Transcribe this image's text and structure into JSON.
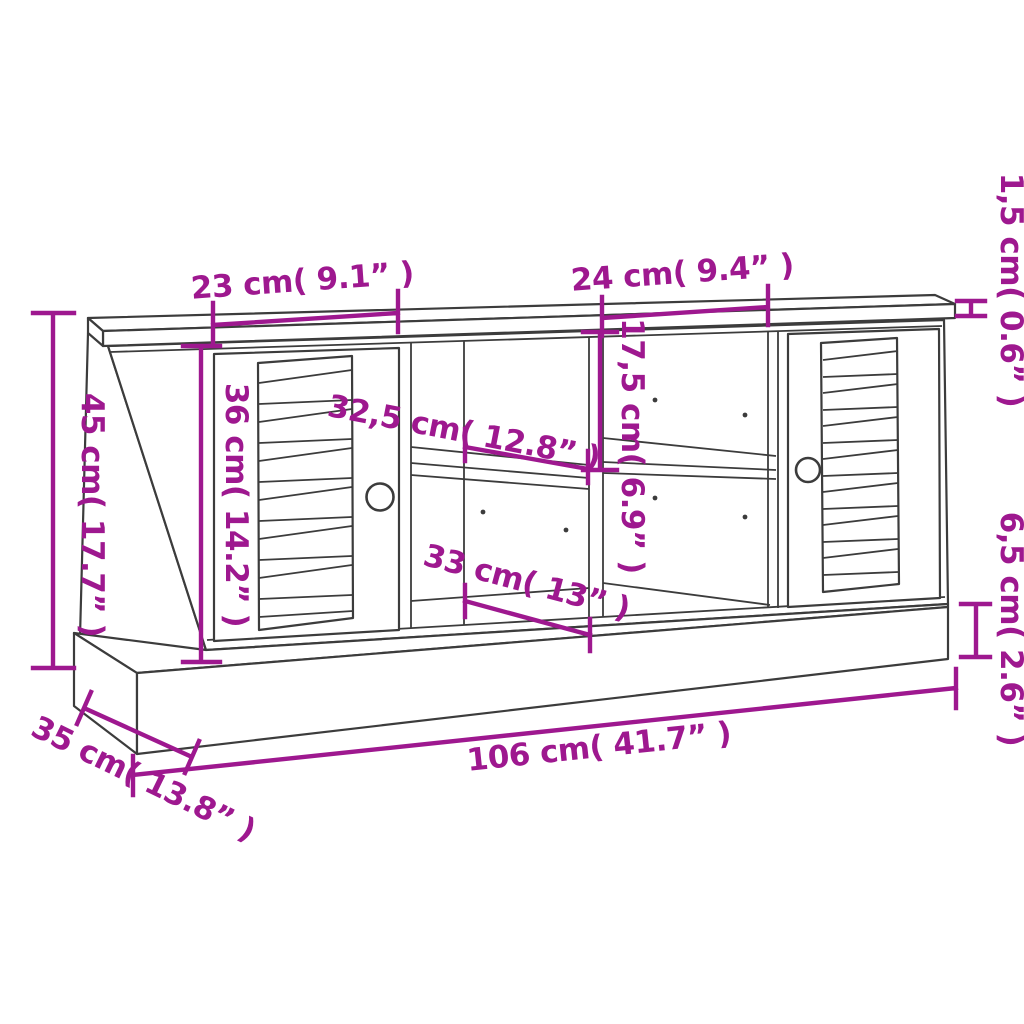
{
  "diagram_type": "furniture-dimension-diagram",
  "product": "TV bench with two louvre doors, open middle compartments and plinth base",
  "colors": {
    "annotation": "#9E188F",
    "outline": "#3C3C3C",
    "background": "#FFFFFF"
  },
  "dimensions": {
    "left_door_width": {
      "label": "23 cm( 9.1” )",
      "cm": 23,
      "inches": 9.1
    },
    "right_compartment_width": {
      "label": "24 cm( 9.4” )",
      "cm": 24,
      "inches": 9.4
    },
    "top_panel_thickness": {
      "label": "1,5 cm( 0.6” )",
      "cm": 1.5,
      "inches": 0.6
    },
    "overall_height": {
      "label": "45 cm( 17.7” )",
      "cm": 45,
      "inches": 17.7
    },
    "body_height": {
      "label": "36 cm( 14.2” )",
      "cm": 36,
      "inches": 14.2
    },
    "shelf_width": {
      "label": "32,5 cm( 12.8” )",
      "cm": 32.5,
      "inches": 12.8
    },
    "upper_compartment_height": {
      "label": "17,5 cm( 6.9” )",
      "cm": 17.5,
      "inches": 6.9
    },
    "lower_compartment_width": {
      "label": "33 cm( 13” )",
      "cm": 33,
      "inches": 13
    },
    "plinth_height": {
      "label": "6,5 cm( 2.6” )",
      "cm": 6.5,
      "inches": 2.6
    },
    "overall_width": {
      "label": "106 cm( 41.7” )",
      "cm": 106,
      "inches": 41.7
    },
    "overall_depth": {
      "label": "35 cm( 13.8” )",
      "cm": 35,
      "inches": 13.8
    }
  }
}
